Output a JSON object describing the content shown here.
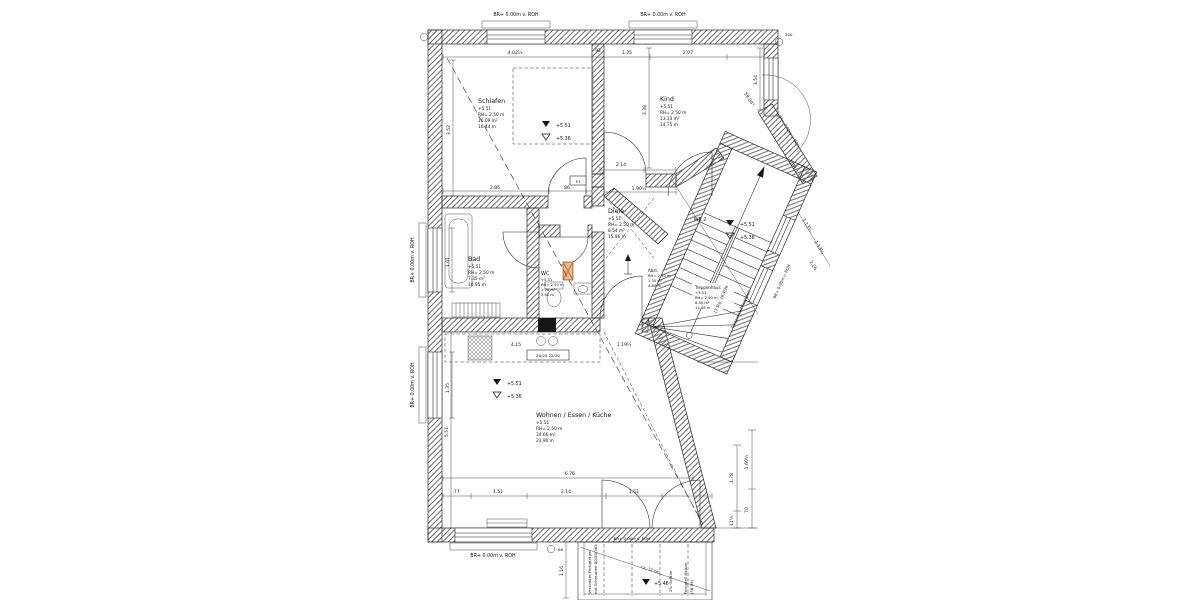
{
  "drawing": {
    "rooms": [
      {
        "name": "Schlafen",
        "level": "+5.51",
        "height": "RH= 2.50 m",
        "area": "16.09 m²",
        "perimeter": "16.44 m"
      },
      {
        "name": "Kind",
        "level": "+5.51",
        "height": "RH= 2.50 m",
        "area": "13.33 m²",
        "perimeter": "14.75 m"
      },
      {
        "name": "Diele",
        "level": "+5.51",
        "height": "RH= 2.50 m",
        "area": "8.54 m²",
        "perimeter": "15.96 m"
      },
      {
        "name": "Bad",
        "level": "+5.51",
        "height": "RH= 2.50 m",
        "area": "7.35 m²",
        "perimeter": "10.95 m"
      },
      {
        "name": "WC",
        "level": "+5.51",
        "height": "RH= 2.50 m",
        "area": "1.98 m²",
        "perimeter": "5.60 m"
      },
      {
        "name": "Wohnen / Essen / Küche",
        "level": "+5.51",
        "height": "RH= 2.50 m",
        "area": "34.66 m²",
        "perimeter": "23.90 m"
      },
      {
        "name": "Treppenhaus",
        "level": "+5.51",
        "height": "RH= 2.50 m",
        "area": "6.50 m²",
        "perimeter": "11.08 m"
      },
      {
        "name": "Abst.",
        "height": "RH= 2.50 m",
        "area": "1.35 m²",
        "perimeter": "4.80 m"
      }
    ],
    "levels": {
      "ffb": "+5.51",
      "rfb": "+5.36",
      "balcony": "+5.46"
    },
    "annotations": {
      "wall_label": "BR+ 0.00m v. ROH",
      "unit": "WE 2",
      "beam_tag": "20/20 22/30",
      "door_tag": "F3",
      "stair_note_1": "13 Stg. 18.4/26",
      "stair_note_2": "Treppenlauf Fertigteil",
      "balcony_slope": "2% Gefälle",
      "balcony_part_1": "Fertigteil Balkon",
      "balcony_part_2": "(FB 04)",
      "girder_1": "Verzinkter Fertigträger",
      "girder_2": "mit Schrauben 80/50/365",
      "balcony_gap": "ca. 12 cm",
      "mark_500": "500",
      "mark_66": "66"
    },
    "dims": {
      "top": [
        "4.02½",
        "92",
        "1.25",
        "2.07"
      ],
      "schlafen_bottom": [
        "2.86",
        "86"
      ],
      "schlafen_height": "3.52",
      "kind_height": "3.38",
      "kind_right": "1.54",
      "kind_door": "2.14",
      "diele_top": "1.90½",
      "kitchen": [
        "4.15",
        "1.19½"
      ],
      "wohnen_width": "6.76",
      "wohnen_bottom": [
        ".77",
        "1.51",
        "2.14",
        "1.51"
      ],
      "wohnen_height": "5.51",
      "bad_left": [
        "1.01",
        "1.35"
      ],
      "diag_main": "7.28",
      "diag_chain": [
        "1.13½",
        "1.13½",
        "2.26"
      ],
      "angle": "59.04°",
      "right_chain": [
        "1.78",
        "11½",
        "1.60½",
        "70"
      ],
      "balcony_left": "1.16"
    },
    "colors": {
      "shaft_orange": "#c96f2e"
    }
  }
}
